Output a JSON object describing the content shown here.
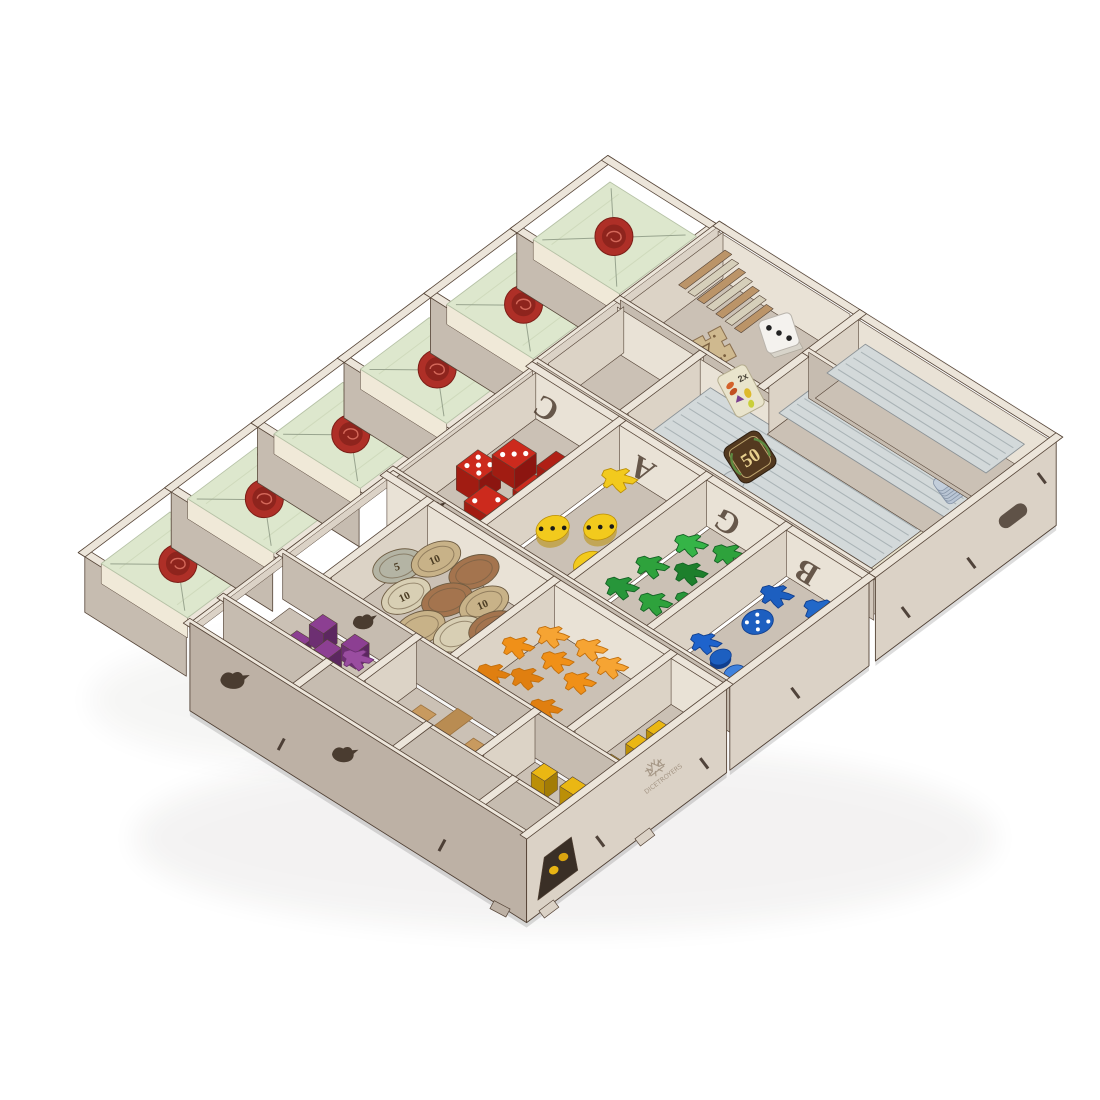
{
  "image_type": "product-photo",
  "subject": "laser-cut wooden board game organizer insert filled with game components, angled view on white background",
  "background_color": "#ffffff",
  "brand": {
    "logo_text": "DICETROYERS"
  },
  "etched_letters": [
    "C",
    "A",
    "G",
    "B"
  ],
  "tokens": {
    "score_tile": "50",
    "multiplier_tile": "2x",
    "coin_value_large": "10",
    "coin_value_small": "5"
  },
  "palette": {
    "wood_rim": "#ece5da",
    "wood_face_lit": "#dbd2c6",
    "wood_face_mid": "#d2c8bc",
    "wood_face_shadow": "#c6bcb0",
    "wood_face_dark": "#bdb1a5",
    "wood_floor": "#cbc1b5",
    "wood_inner_lit": "#e9e2d6",
    "wood_inner_mid": "#dcd3c6",
    "burn": "#554437",
    "tile_green": "#dde7cd",
    "tile_line": "#98a48e",
    "seal_red": "#ae2f27",
    "seal_dark": "#8e241d",
    "die_red": "#cc2a1d",
    "die_red_side": "#a11c12",
    "die_red_dark": "#8c1510",
    "die_yellow": "#f2ca1d",
    "meeple_green": "#2ea23c",
    "piece_blue": "#1d5fc0",
    "piece_blue_dark": "#113f8e",
    "piece_purple": "#8c3f92",
    "piece_purple_dark": "#6d2f72",
    "meeple_orange": "#f09018",
    "meeple_orange_dark": "#c26f0d",
    "piece_natural": "#c89a5f",
    "piece_natural_dark": "#9e7440",
    "cube_yellow": "#eab713",
    "cube_yellow_dark": "#bb8f07",
    "card_back": "#d3d9da",
    "card_stripe": "#aab3b6",
    "card_cream": "#e6e1cd",
    "card_brown_edge": "#bb9468",
    "score_tile_bg": "#53391f",
    "score_tile_text": "#e8d08f",
    "coin_silver": "#b4b4a4",
    "coin_tan": "#c8b288",
    "coin_brown": "#a4744e",
    "coin_pale": "#d8cfb4",
    "coin_text": "#4c3d24",
    "white_die": "#f4f2ee",
    "etch": "#4a392c",
    "logo_etch": "#9a8a78"
  },
  "compartments": [
    {
      "name": "sealed-letter-stack-1",
      "contents": "letter tiles with red wax seal"
    },
    {
      "name": "sealed-letter-stack-2",
      "contents": "letter tiles with red wax seal"
    },
    {
      "name": "sealed-letter-stack-3",
      "contents": "letter tiles with red wax seal"
    },
    {
      "name": "sealed-letter-stack-4",
      "contents": "letter tiles with red wax seal"
    },
    {
      "name": "sealed-letter-stack-5",
      "contents": "letter tiles with red wax seal"
    },
    {
      "name": "sealed-letter-stack-6",
      "contents": "letter tiles with red wax seal"
    },
    {
      "name": "red-dice-box",
      "contents": "red dice and cubes"
    },
    {
      "name": "yellow-dice-box",
      "contents": "yellow rounded dice and meeple"
    },
    {
      "name": "green-meeples-box",
      "contents": "green meeples"
    },
    {
      "name": "blue-pieces-box",
      "contents": "blue discs, die and meeples"
    },
    {
      "name": "coins-box",
      "contents": "cardboard coins"
    },
    {
      "name": "purple-pieces-box",
      "contents": "purple cubes and meeple"
    },
    {
      "name": "natural-pieces-box",
      "contents": "natural wood planks"
    },
    {
      "name": "orange-meeples-box",
      "contents": "orange meeples"
    },
    {
      "name": "yellow-cubes-box-1",
      "contents": "yellow cubes"
    },
    {
      "name": "yellow-cubes-box-2",
      "contents": "yellow cubes"
    },
    {
      "name": "token-bay",
      "contents": "hourglass token, white die, brown card fan"
    },
    {
      "name": "card-bay-1",
      "contents": "card stack, 2x tile, 50 score tile"
    },
    {
      "name": "card-bay-2",
      "contents": "card stack, small blue tile stack"
    },
    {
      "name": "card-bay-3",
      "contents": "card stack"
    },
    {
      "name": "empty-small-box-1",
      "contents": ""
    },
    {
      "name": "empty-small-box-2",
      "contents": ""
    },
    {
      "name": "empty-small-box-3",
      "contents": ""
    },
    {
      "name": "empty-small-box-4",
      "contents": ""
    }
  ],
  "counts": {
    "red_dice": 5,
    "yellow_dice": 3,
    "yellow_meeples": 1,
    "green_meeples": 7,
    "blue_pieces": 7,
    "purple_pieces": 5,
    "orange_meeples": 9,
    "natural_pieces": 3,
    "yellow_cubes": 9,
    "coins": 9,
    "letter_tile_stacks": 6,
    "card_stacks": 4,
    "blue_tiles": 6,
    "white_die": 1,
    "hourglass_token": 1
  }
}
